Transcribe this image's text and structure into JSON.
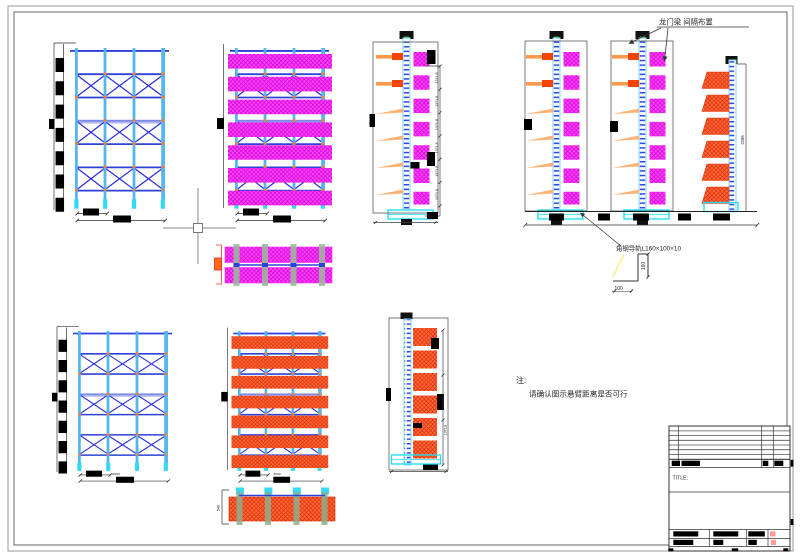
{
  "labels": {
    "gantry_beam": "龙门梁  间隔布置",
    "angle_rail": "角钢导轨L160×100×10",
    "note_head": "注:",
    "note_body": "请确认图示悬臂距离是否可行",
    "title_label": "TITLE:"
  },
  "dimensions": {
    "angle_leg_height": "160",
    "angle_leg_width": "100",
    "stack_height": "2286",
    "level_height": "1371.8",
    "plan_depth": "540",
    "bay_width": "3000"
  },
  "colors": {
    "frame_beam_blue": "#2e41d6",
    "column_blue": "#56b6f2",
    "brace_blue": "#2a2ce0",
    "magenta_load": "#ff46ff",
    "orange_load": "#ff7040",
    "arm_orange": "#ff9a4d",
    "arm_tip_red": "#f34300",
    "connector_orange": "#ff7f27",
    "base_cyan": "#19dff2",
    "titleblock_pink": "#ff9b9b"
  }
}
